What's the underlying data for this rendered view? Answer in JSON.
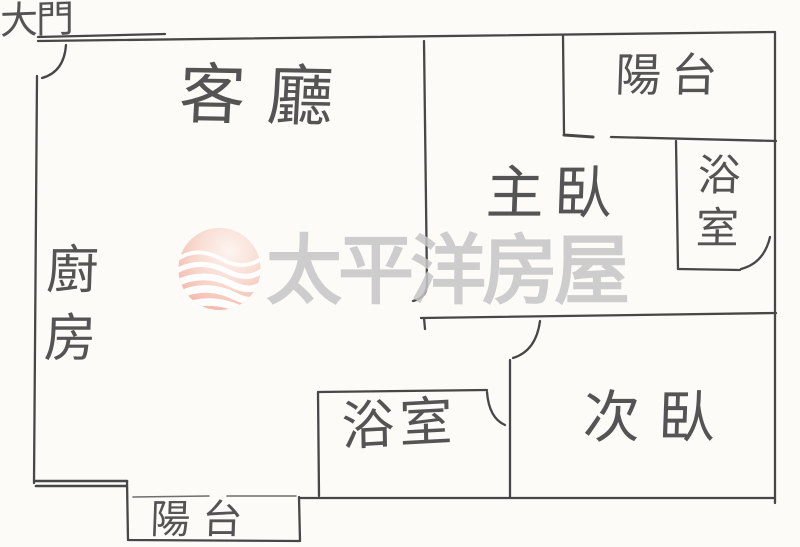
{
  "paper": {
    "background_color": "#fcfbf8",
    "ink_color": "#474747"
  },
  "watermark": {
    "brand_text": "太平洋房屋",
    "text_color": "#c6c6c6",
    "logo": {
      "name": "pacific-sphere-waves-logo",
      "pink": "#f3b0a1",
      "highlight": "#fdf4f0",
      "wave_color": "#ffffff"
    }
  },
  "rooms": {
    "main_door": "大門",
    "living_room": "客廳",
    "kitchen": "廚房",
    "master_bedroom": "主臥",
    "second_bedroom": "次臥",
    "bathroom_top": "浴室",
    "bathroom_bottom": "浴室",
    "balcony_top": "陽台",
    "balcony_bottom": "陽台"
  }
}
